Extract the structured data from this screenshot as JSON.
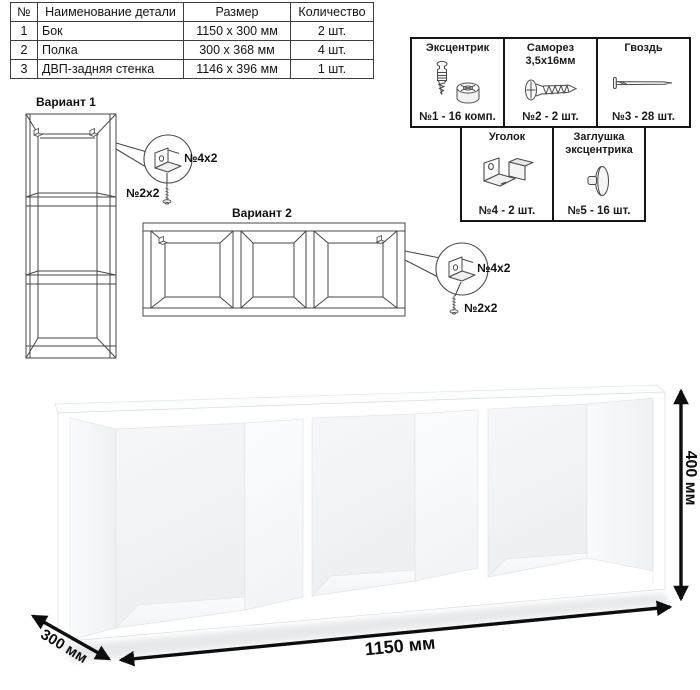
{
  "colors": {
    "background": "#ffffff",
    "line": "#1a1a1a",
    "furniture_white": "#ffffff"
  },
  "parts_table": {
    "headers": [
      "№",
      "Наименование детали",
      "Размер",
      "Количество"
    ],
    "rows": [
      {
        "num": "1",
        "name": "Бок",
        "size": "1150 x 300 мм",
        "qty": "2 шт."
      },
      {
        "num": "2",
        "name": "Полка",
        "size": "300 x 368 мм",
        "qty": "4 шт."
      },
      {
        "num": "3",
        "name": "ДВП-задняя стенка",
        "size": "1146 x 396 мм",
        "qty": "1 шт."
      }
    ]
  },
  "hardware_box": {
    "items": [
      {
        "title": "Эксцентрик",
        "count": "№1 - 16 комп.",
        "icon": "cam-bolt-and-housing"
      },
      {
        "title": "Саморез\n3,5х16мм",
        "count": "№2 - 2 шт.",
        "icon": "wood-screw"
      },
      {
        "title": "Гвоздь",
        "count": "№3 - 28 шт.",
        "icon": "nail"
      },
      {
        "title": "Уголок",
        "count": "№4 - 2 шт.",
        "icon": "corner-bracket"
      },
      {
        "title": "Заглушка\nэксцентрика",
        "count": "№5 - 16 шт.",
        "icon": "cam-cap"
      }
    ]
  },
  "variant1": {
    "title": "Вариант 1",
    "bracket_label": "№4х2",
    "screw_label": "№2х2"
  },
  "variant2": {
    "title": "Вариант 2",
    "bracket_label": "№4х2",
    "screw_label": "№2х2"
  },
  "dimensions": {
    "width_label": "1150 мм",
    "depth_label": "300 мм",
    "height_label": "400 мм"
  }
}
